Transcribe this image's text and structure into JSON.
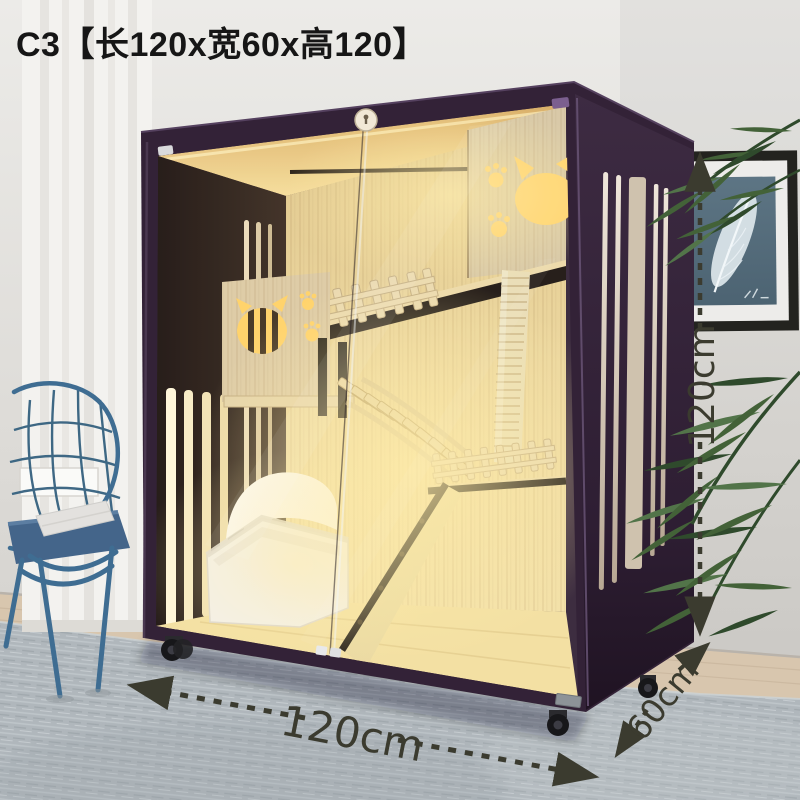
{
  "page": {
    "product_title": "C3【长120x宽60x高120】"
  },
  "dimensions": {
    "width_label": "120cm",
    "depth_label": "60cm",
    "height_label": "120cm"
  },
  "colors": {
    "annotation": "#3b3b2f",
    "title-ink": "#161616",
    "frame": "#332237",
    "frame-dark": "#221525",
    "interior-glow": "#ffd565",
    "wood-light": "#e9d6a4",
    "wood-back": "#e4cf96",
    "cutout-glow": "#ffd166",
    "sisal": "#e9ddb6",
    "litter-white": "#f3f1ed",
    "wall": "#d9d7d3",
    "curtain": "#f3f2ef",
    "rug": "#b0b7bc",
    "floor-wood": "#d8c6ae",
    "chair-blue": "#3f6d92",
    "cushion-blue": "#44658a",
    "plant-green": "#436238",
    "art-blue": "#56707f"
  }
}
